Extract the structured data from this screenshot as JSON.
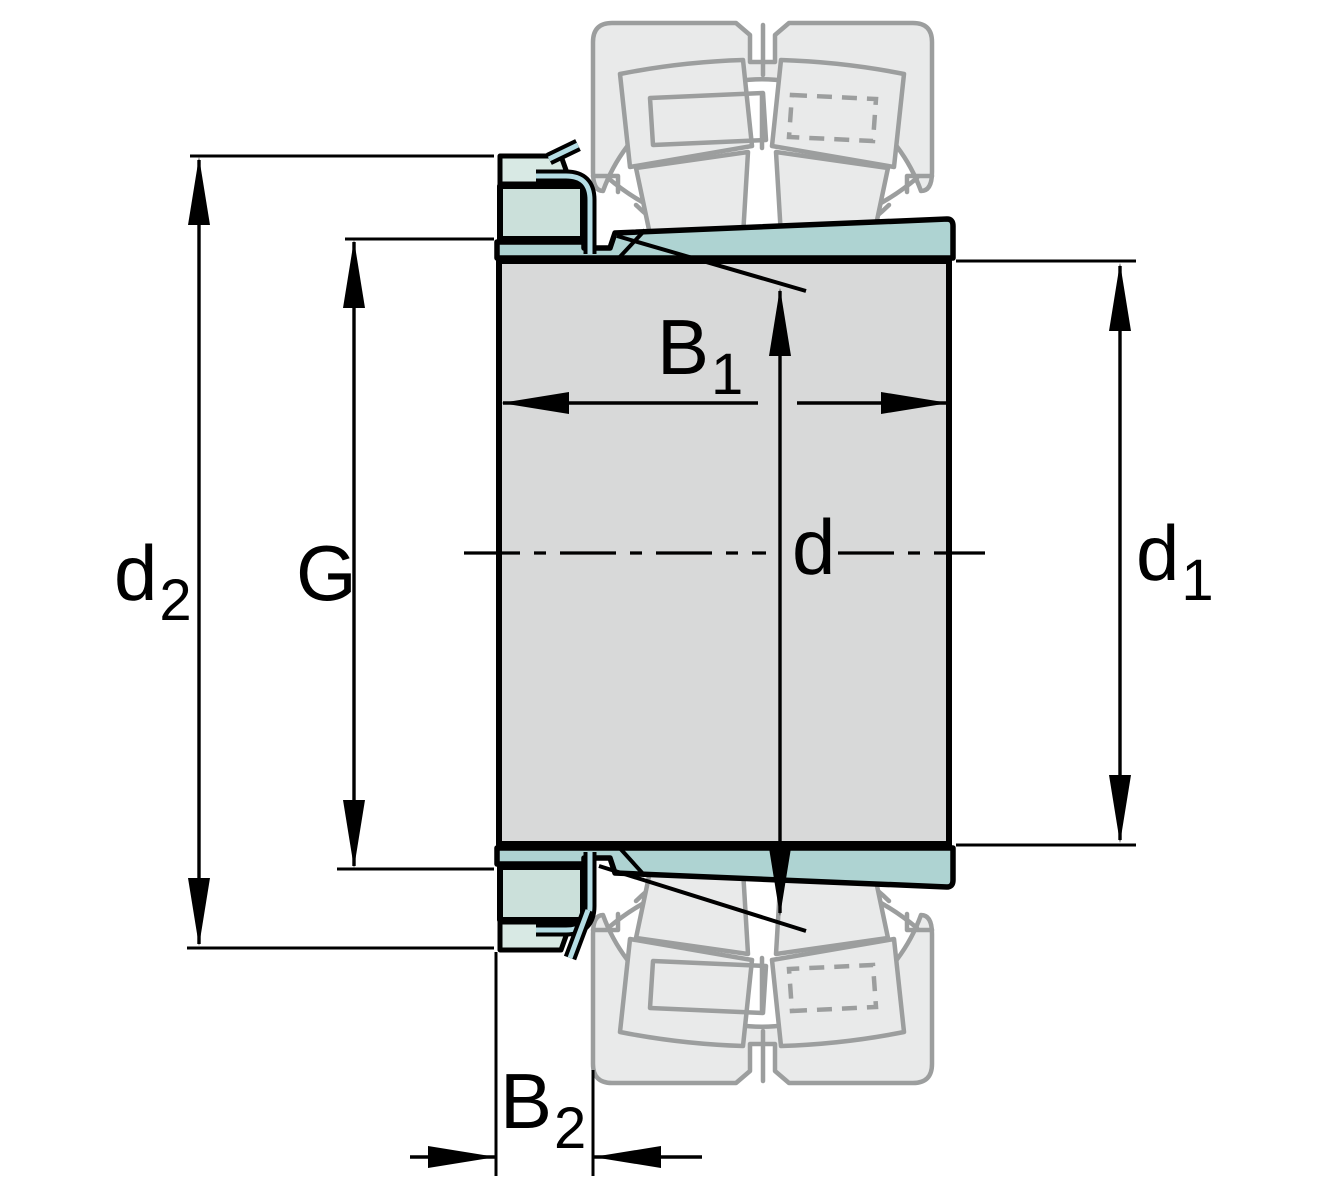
{
  "diagram": {
    "labels": {
      "d2": {
        "base": "d",
        "sub": "2"
      },
      "G": {
        "base": "G"
      },
      "B1": {
        "base": "B",
        "sub": "1"
      },
      "d": {
        "base": "d"
      },
      "d1": {
        "base": "d",
        "sub": "1"
      },
      "B2": {
        "base": "B",
        "sub": "2"
      }
    },
    "colors": {
      "background": "#ffffff",
      "line-black": "#000000",
      "ghost-stroke": "#9c9e9e",
      "ghost-fill": "#e9eaea",
      "shaft-fill": "#d8d9d9",
      "sleeve-fill": "#aed3d2",
      "nut-fill": "#cbe0da",
      "nut-band-fill": "#d8e9e4",
      "washer-fill": "#b5dde4"
    }
  }
}
